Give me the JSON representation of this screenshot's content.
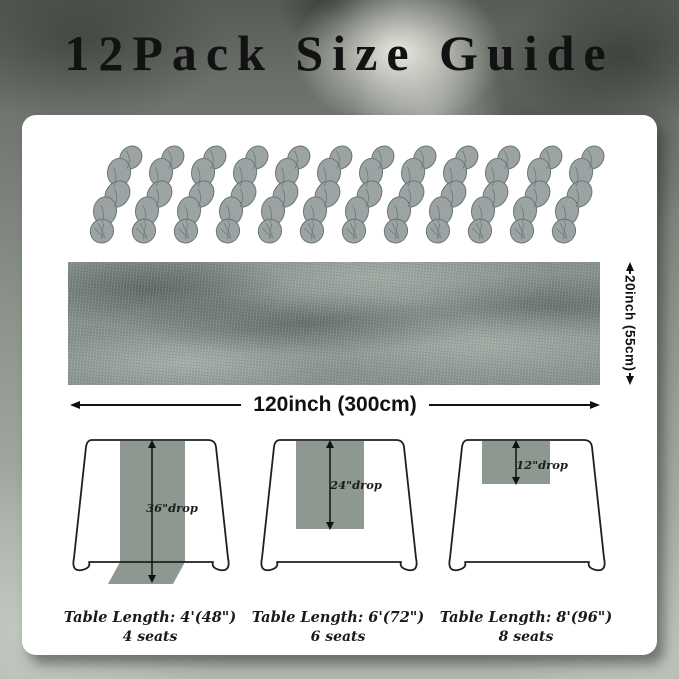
{
  "title": "12Pack Size Guide",
  "bundles": {
    "count": 12,
    "description": "stacked fabric runner bundles"
  },
  "runner": {
    "width_label": "120inch (300cm)",
    "height_label": "20inch (55cm)"
  },
  "tables": [
    {
      "drop_label": "36\"drop",
      "length_label": "Table Length: 4'(48\")",
      "seats_label": "4 seats"
    },
    {
      "drop_label": "24\"drop",
      "length_label": "Table Length: 6'(72\")",
      "seats_label": "6 seats"
    },
    {
      "drop_label": "12\"drop",
      "length_label": "Table Length: 8'(96\")",
      "seats_label": "8 seats"
    }
  ],
  "colors": {
    "runner": "#8d9891",
    "bundle": "#9ba3a3",
    "bundle_shade": "#6b7575",
    "card": "#ffffff",
    "ink": "#111111"
  }
}
